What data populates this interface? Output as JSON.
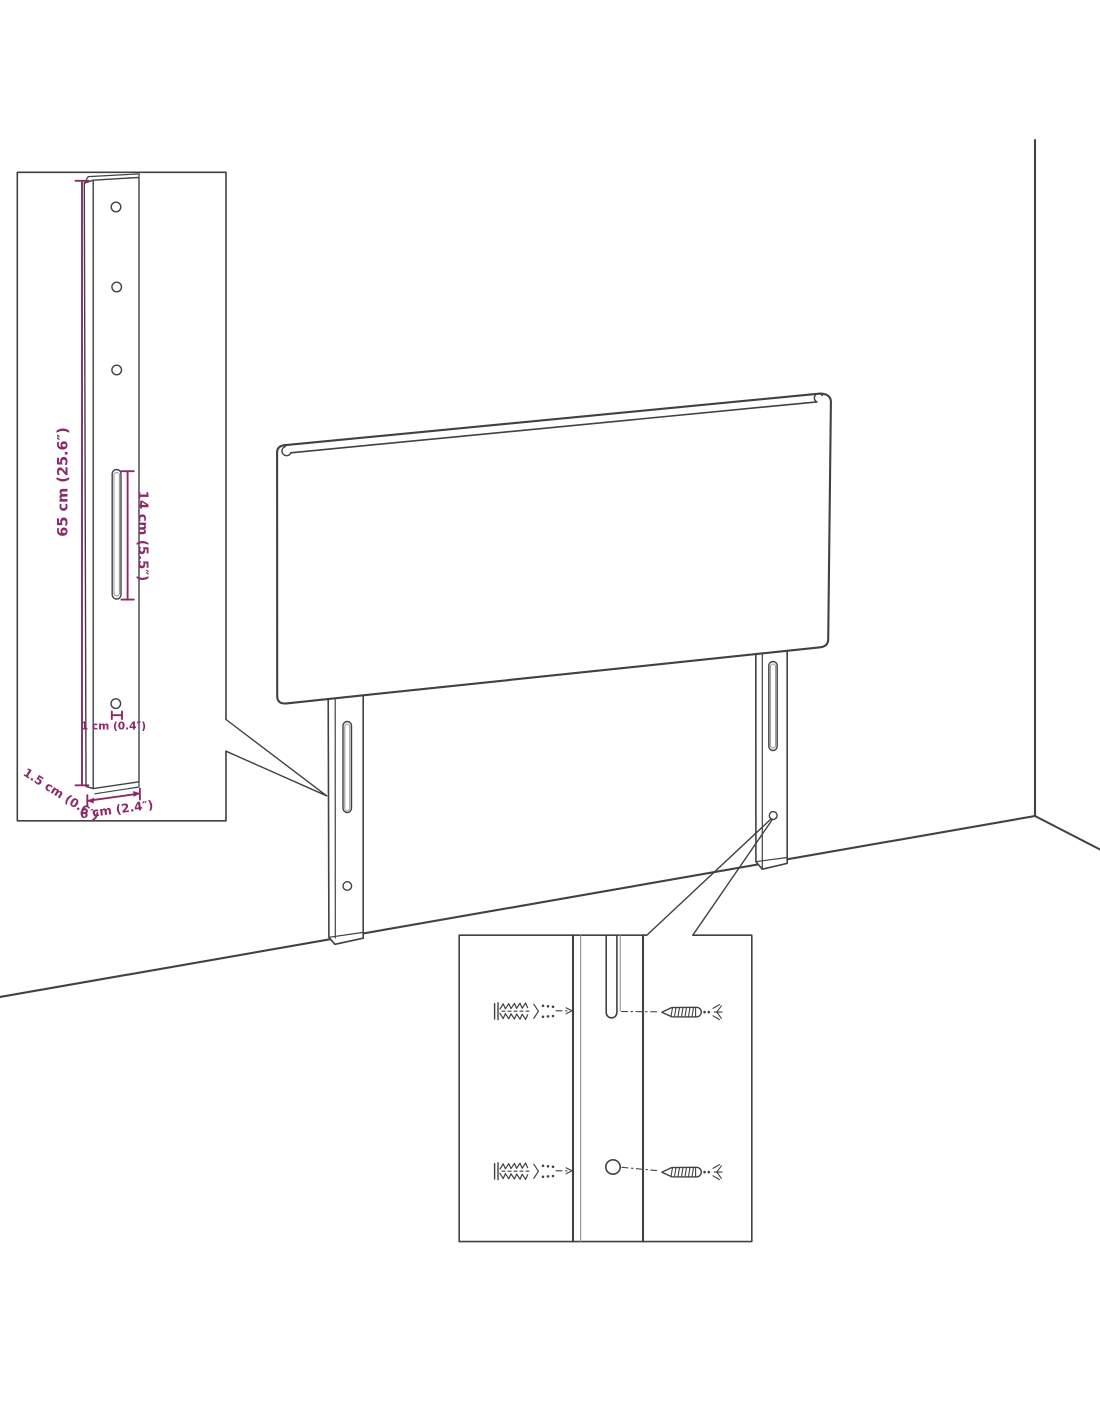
{
  "colors": {
    "background": "#ffffff",
    "line": "#414141",
    "line_light": "#9b9b9b",
    "dimension_accent": "#8b2a6a"
  },
  "bracket_inset": {
    "dim_height_label": "65 cm (25.6″)",
    "dim_slot_label": "14 cm (5.5″)",
    "dim_hole_label": "1 cm (0.4″)",
    "dim_thickness_label": "1.5 cm (0.6″)",
    "dim_width_label": "6 cm (2.4″)"
  }
}
